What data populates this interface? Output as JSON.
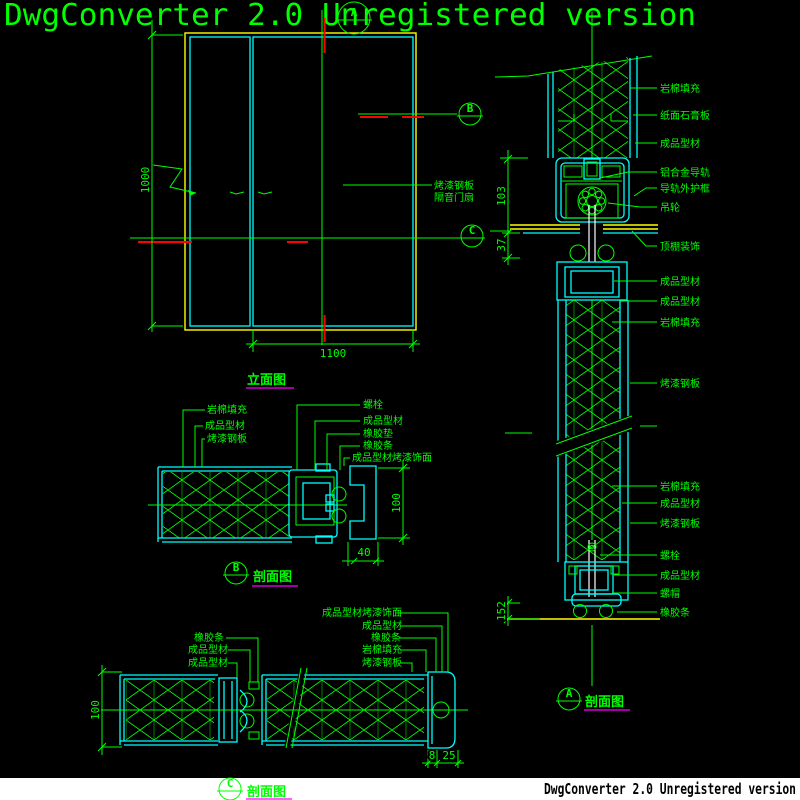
{
  "watermarks": {
    "top": "DwgConverter 2.0 Unregistered version",
    "bottom": "DwgConverter 2.0 Unregistered version"
  },
  "colors": {
    "background": "#000000",
    "line_green": "#00ff00",
    "profile_cyan": "#00ffff",
    "frame_yellow": "#ffff00",
    "centerline_red": "#ff0000",
    "underline_magenta": "#ff00ff",
    "band_white": "#ffffff",
    "bottom_text_black": "#000000"
  },
  "views": {
    "elevation": {
      "title": "立面图",
      "dim_height": "1000",
      "dim_width": "1100",
      "note_line1": "烤漆钢板",
      "note_line2": "隔音门扇"
    },
    "section_a": {
      "marker": "A",
      "title": "剖面图",
      "dim_track": "103",
      "dim_gap": "37",
      "dim_bottom": "152",
      "labels": [
        "岩棉填充",
        "纸面石膏板",
        "成品型材",
        "铝合金导轨",
        "导轨外护框",
        "吊轮",
        "顶棚装饰",
        "成品型材",
        "成品型材",
        "岩棉填充",
        "烤漆钢板",
        "岩棉填充",
        "成品型材",
        "烤漆钢板",
        "螺栓",
        "成品型材",
        "螺帽",
        "橡胶条"
      ]
    },
    "section_b": {
      "marker": "B",
      "title": "剖面图",
      "dim_height": "100",
      "dim_width": "40",
      "labels_left": [
        "岩棉填充",
        "成品型材",
        "烤漆钢板"
      ],
      "labels_right": [
        "螺栓",
        "成品型材",
        "橡胶垫",
        "橡胶条",
        "成品型材烤漆饰面"
      ]
    },
    "section_c": {
      "marker": "C",
      "title": "剖面图",
      "dim_height": "100",
      "dim_seg1": "8",
      "dim_seg2": "25",
      "labels_left": [
        "橡胶条",
        "成品型材",
        "成品型材"
      ],
      "labels_right": [
        "成品型材烤漆饰面",
        "成品型材",
        "橡胶条",
        "岩棉填充",
        "烤漆钢板"
      ]
    }
  }
}
